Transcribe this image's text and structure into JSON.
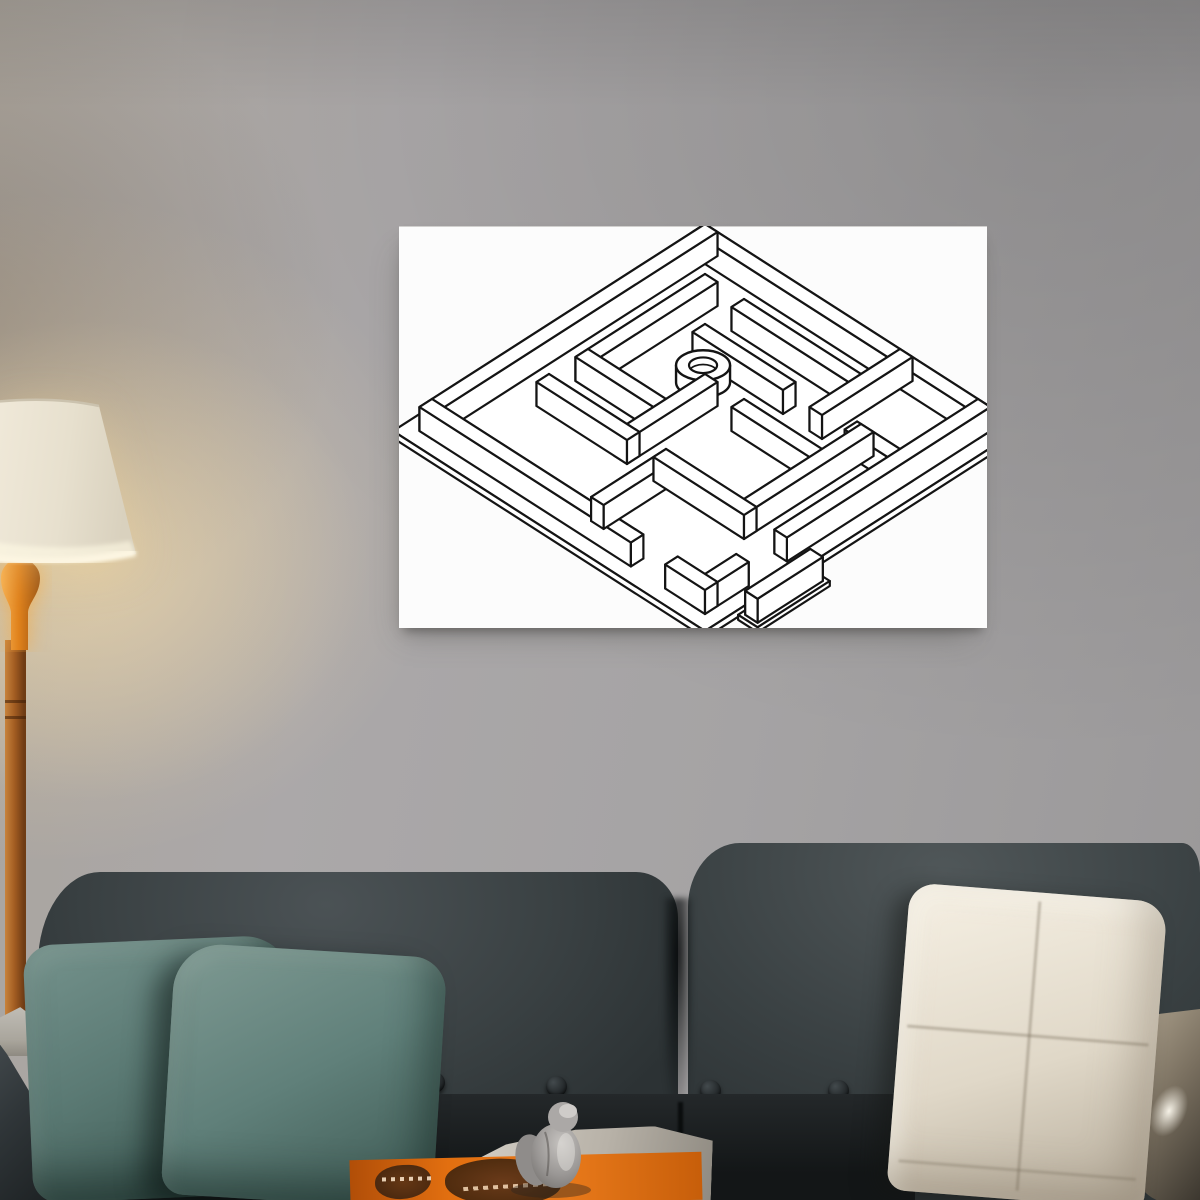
{
  "scene": {
    "kind": "living-room photo with poster mockup",
    "width": 1200,
    "height": 1200
  },
  "colors": {
    "wall_base": "#a6a3a4",
    "wall_glow": "#f2d9aa",
    "poster_bg": "#fcfcfc",
    "maze_line": "#141414",
    "sofa_dark": "#2d3335",
    "sofa_mid": "#3b4244",
    "pillow_teal": "#5b7a74",
    "pillow_teal_light": "#7a968f",
    "pillow_cream": "#e0d8c8",
    "pillow_beige_dark": "#7a7060",
    "lamp_orange": "#e0821c",
    "lamp_pole": "#a35d22",
    "lamp_shade": "#e9e2d1",
    "magazine_orange": "#e26f10",
    "paper_gray": "#b8b2a8",
    "figurine_gray": "#9a9795"
  },
  "poster": {
    "art": "isometric-maze-line-drawing",
    "maze": {
      "ox": 306,
      "oy": 30,
      "sx": 39,
      "sy": 25,
      "wallH": 24,
      "wallT": 0.32,
      "strokeW": 2.2,
      "stroke": "#141414",
      "platePad": 0.5,
      "plateThick": 7,
      "walls": [
        [
          0,
          0,
          0,
          7
        ],
        [
          0,
          0,
          7,
          0
        ],
        [
          7,
          0,
          7,
          5.1
        ],
        [
          7,
          6.3,
          7,
          7
        ],
        [
          0,
          7,
          4.9,
          7
        ],
        [
          6.2,
          7,
          7,
          7
        ],
        [
          1,
          1,
          4,
          1
        ],
        [
          1,
          2,
          1,
          5
        ],
        [
          0,
          5,
          2,
          5
        ],
        [
          2,
          5.9,
          2,
          7
        ],
        [
          2,
          2,
          2,
          4
        ],
        [
          3,
          3,
          5,
          3
        ],
        [
          4,
          1,
          4,
          3
        ],
        [
          3,
          4,
          3,
          6
        ],
        [
          2,
          6,
          5,
          6
        ],
        [
          5,
          4,
          5,
          6
        ],
        [
          5,
          4,
          6.6,
          4
        ],
        [
          5,
          1,
          5,
          3
        ],
        [
          5.15,
          7.85,
          6.5,
          7.85
        ]
      ],
      "strip": {
        "r1": 4.9,
        "c1": 7.6,
        "r2": 6.75,
        "c2": 8.1,
        "thick": 5
      },
      "ring": {
        "r": 2.55,
        "c": 2.5,
        "rx": 27,
        "ry": 15,
        "h": 17,
        "hole": 0.52
      }
    }
  },
  "lamp": {
    "pole_ridges_y": [
      700,
      716
    ]
  },
  "sofa": {
    "buttons": [
      {
        "x": 424,
        "y": 1072
      },
      {
        "x": 546,
        "y": 1076
      },
      {
        "x": 700,
        "y": 1080
      },
      {
        "x": 828,
        "y": 1080
      }
    ]
  }
}
